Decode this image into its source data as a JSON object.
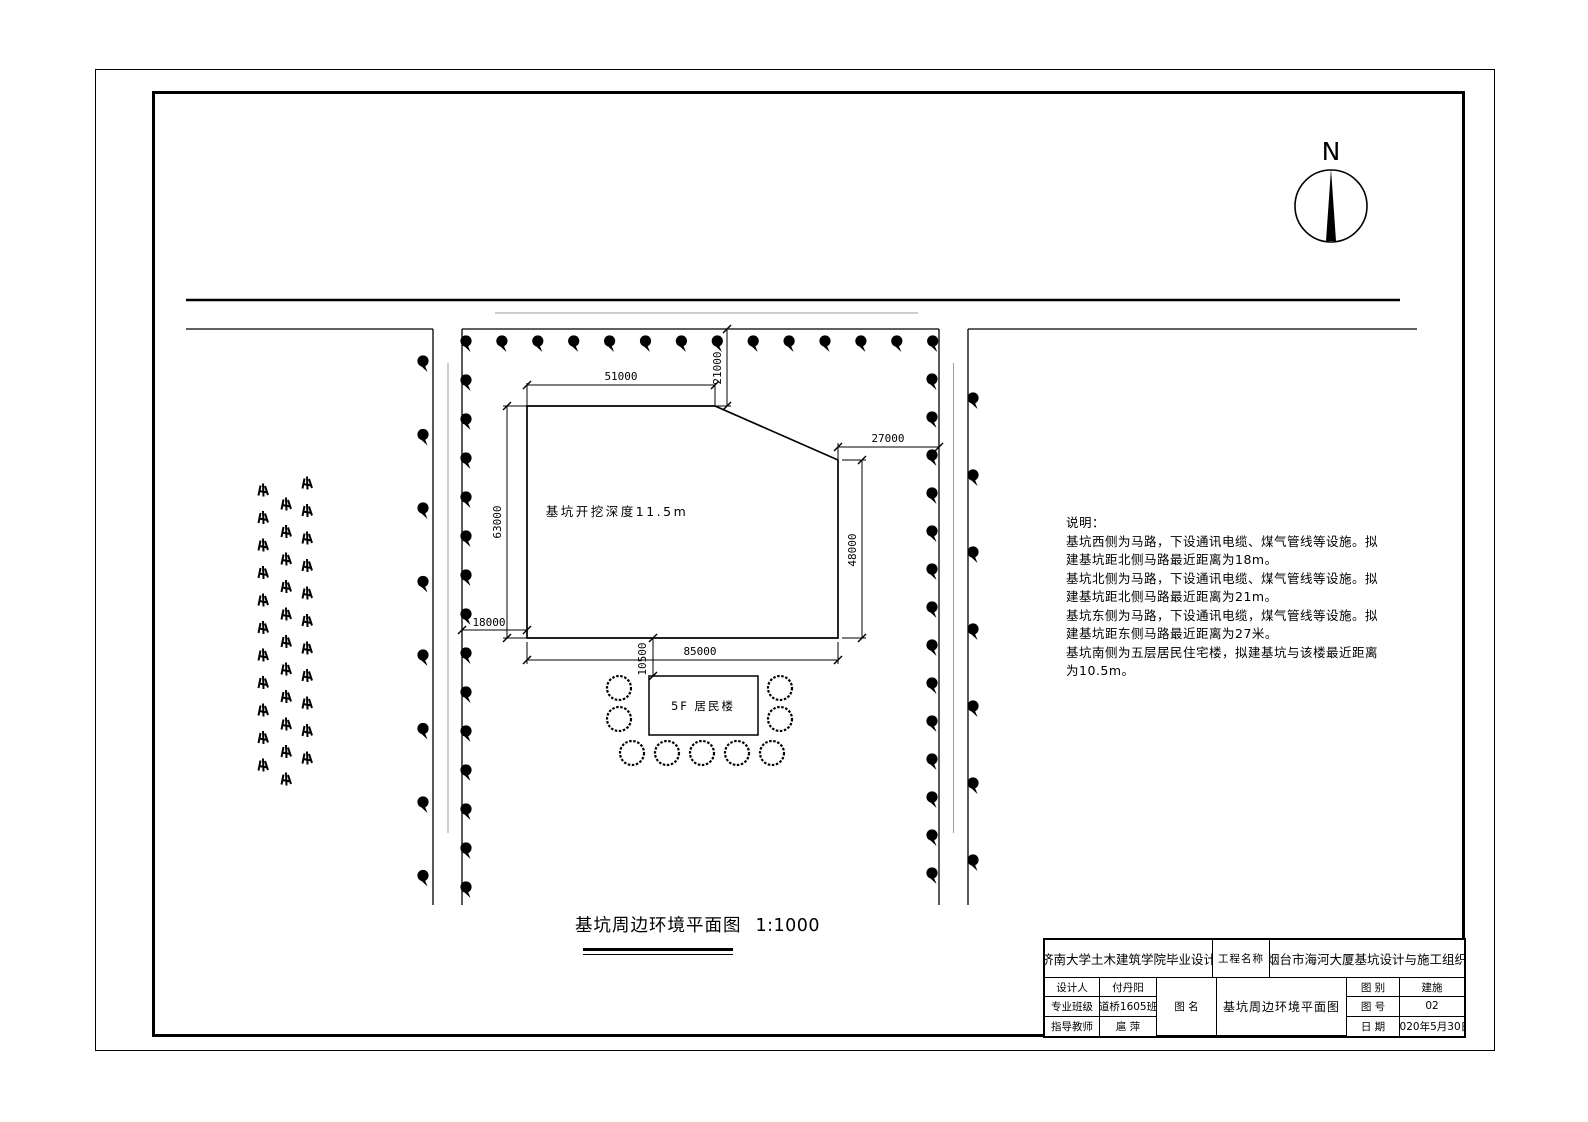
{
  "drawing": {
    "north_label": "N",
    "pit_label": "基坑开挖深度11.5m",
    "building_label": "5F 居民楼",
    "caption": "基坑周边环境平面图",
    "caption_scale": "1:1000",
    "dimensions": {
      "top_width": "51000",
      "north_offset": "21000",
      "left_height": "63000",
      "west_offset": "18000",
      "bottom_width": "85000",
      "south_offset": "10500",
      "right_height": "48000",
      "east_offset": "27000"
    }
  },
  "notes": {
    "lines": [
      "说明：",
      "基坑西侧为马路，下设通讯电缆、煤气管线等设施。拟",
      "建基坑距北侧马路最近距离为18m。",
      "基坑北侧为马路，下设通讯电缆、煤气管线等设施。拟",
      "建基坑距北侧马路最近距离为21m。",
      "基坑东侧为马路，下设通讯电缆，煤气管线等设施。拟",
      "建基坑距东侧马路最近距离为27米。",
      "基坑南侧为五层居民住宅楼，拟建基坑与该楼最近距离",
      "为10.5m。"
    ]
  },
  "title_block": {
    "school": "济南大学土木建筑学院毕业设计",
    "project_label": "工程名称",
    "project_name": "烟台市海河大厦基坑设计与施工组织",
    "designer_label": "设计人",
    "designer": "付丹阳",
    "class_label": "专业班级",
    "class_value": "道桥1605班",
    "advisor_label": "指导教师",
    "advisor": "扈 萍",
    "drawing_name_label": "图  名",
    "drawing_name": "基坑周边环境平面图",
    "category_label": "图  别",
    "category": "建施",
    "number_label": "图  号",
    "number": "02",
    "date_label": "日  期",
    "date": "2020年5月30日"
  },
  "colors": {
    "line": "#000000",
    "centerline": "#9e9e9e",
    "background": "#ffffff"
  }
}
